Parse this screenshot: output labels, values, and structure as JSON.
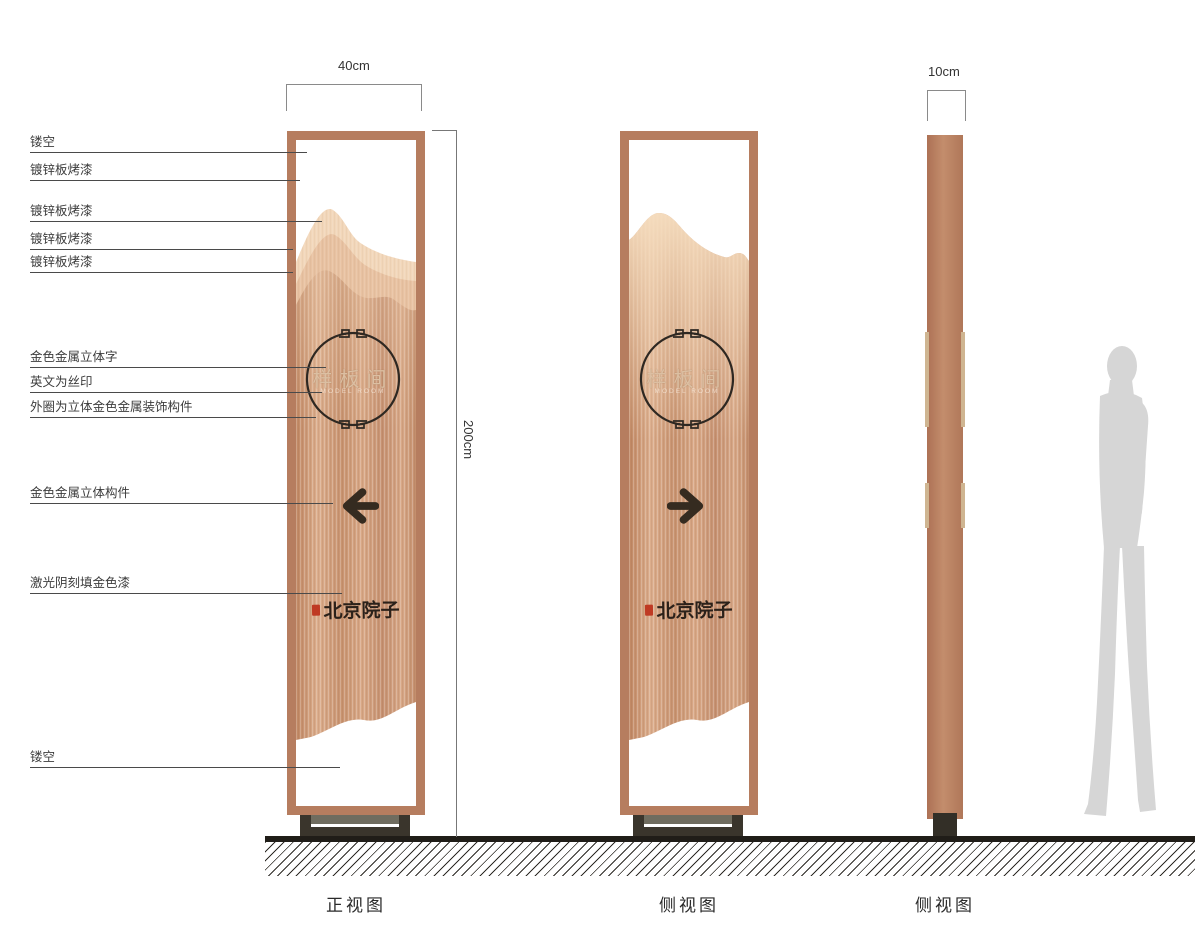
{
  "annotations": [
    {
      "label": "镂空"
    },
    {
      "label": "镀锌板烤漆"
    },
    {
      "label": "镀锌板烤漆"
    },
    {
      "label": "镀锌板烤漆"
    },
    {
      "label": "镀锌板烤漆"
    },
    {
      "label": "金色金属立体字"
    },
    {
      "label": "英文为丝印"
    },
    {
      "label": "外圈为立体金色金属装饰构件"
    },
    {
      "label": "金色金属立体构件"
    },
    {
      "label": "激光阴刻填金色漆"
    },
    {
      "label": "镂空"
    }
  ],
  "dimensions": {
    "front_width": "40cm",
    "height": "200cm",
    "side_width": "10cm"
  },
  "sign": {
    "room_name": "样板间",
    "room_name_en": "MODEL ROOM",
    "brand": "北京院子"
  },
  "views": {
    "front": "正视图",
    "side1": "侧视图",
    "side2": "侧视图"
  },
  "colors": {
    "frame_copper": "#b67d5f",
    "copper_light": "#f2d7ba",
    "accent_dark": "#33291f",
    "seal_red": "#bf3a23",
    "silhouette_gray": "#d6d6d6"
  }
}
